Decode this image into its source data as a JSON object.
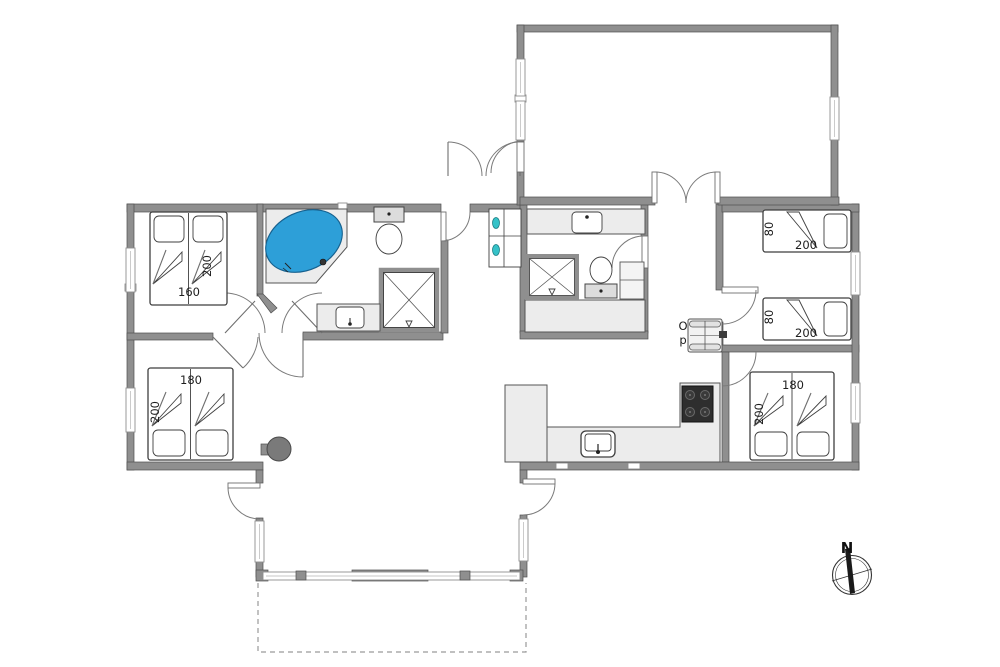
{
  "colors": {
    "wall": "#8f8f8f",
    "wall_edge": "#4f4f4f",
    "tub": "#2d9fd8",
    "appliance_teal": "#35c2c8",
    "counter": "#ececec",
    "cooktop": "#2e2e2e",
    "stove": "#7a7a7a"
  },
  "labels": {
    "bed_nw_width": "160",
    "bed_nw_length": "200",
    "bed_sw_width": "180",
    "bed_sw_length": "200",
    "bed_e1_width": "80",
    "bed_e1_length": "200",
    "bed_e2_width": "80",
    "bed_e2_length": "200",
    "bed_se_width": "180",
    "bed_se_length": "200",
    "stairs_up_line1": "O",
    "stairs_up_line2": "p",
    "compass_north": "N"
  }
}
